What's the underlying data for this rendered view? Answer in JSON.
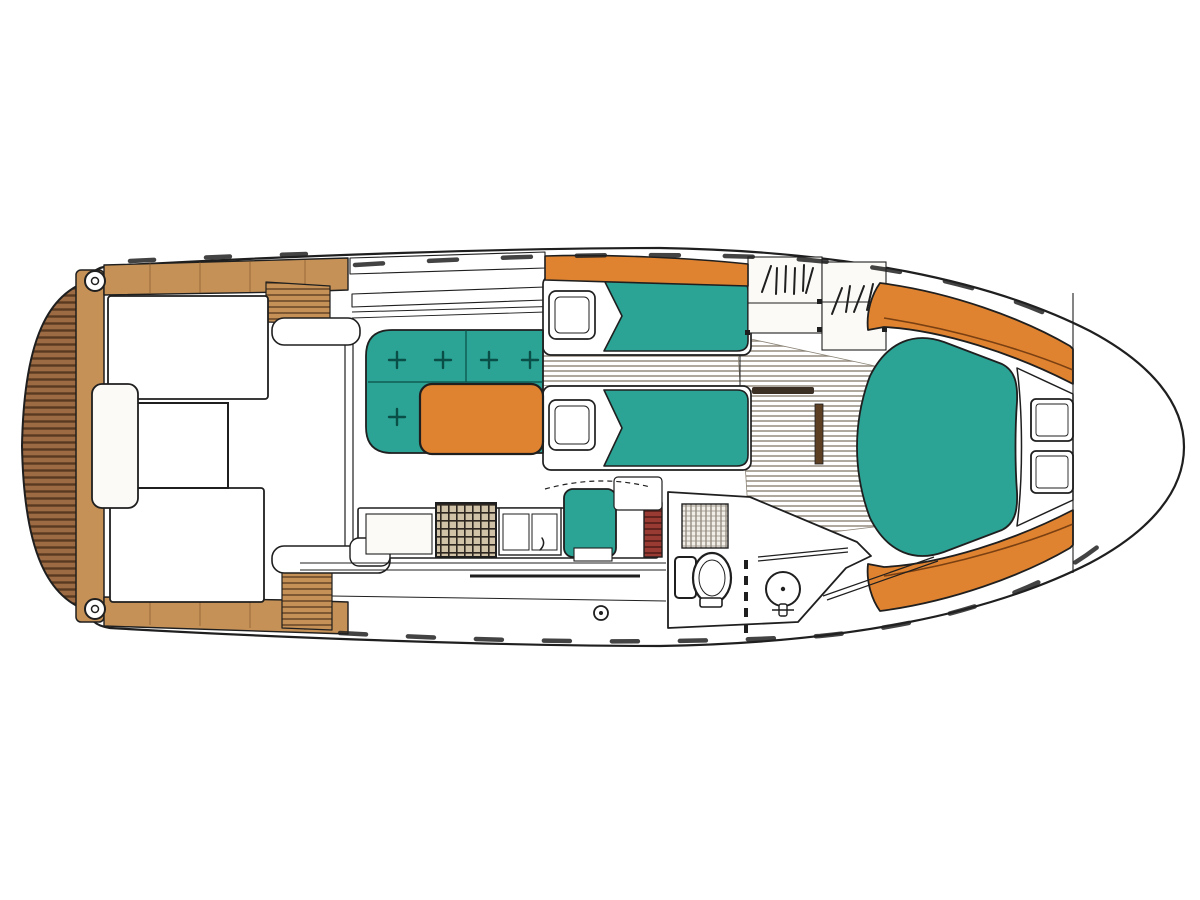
{
  "document": {
    "title": "Motor yacht accommodation / deck floor plan (top view)",
    "type": "boat-floor-plan",
    "orientation": "bow-right",
    "visible_text": []
  },
  "canvas": {
    "width": 1200,
    "height": 900,
    "background": "#ffffff"
  },
  "colors": {
    "line": "#1f1f1f",
    "teal": "#2ba395",
    "tealDark": "#0a4f47",
    "orange": "#e08330",
    "orangeSeam": "#7a4012",
    "teak": "#c59157",
    "teakSeam": "#7c5228",
    "platform": "#9c6b44",
    "platformStripe": "#59391f",
    "floorLine": "#8b8376",
    "maroon": "#993a33",
    "maroonStripe": "#5c1f1b",
    "stoveBase": "#cfc2a6",
    "stoveGrid": "#2e2620",
    "grateBase": "#f1eee8",
    "grateLine": "#948d81"
  },
  "regions": {
    "swim_platform": "Teak swim platform (stern)",
    "transom": "Transom locker band",
    "cockpit": "Aft cockpit with twin benches and table",
    "side_decks": "Port and starboard side decks with steps",
    "windshield": "Wheelhouse windshield",
    "salon": "Salon L-settee with buttoned cushions and table",
    "galley": "Galley: stove, sink, lockers, seat, companionway steps",
    "mid_cabin": "Mid cabin with two single berths and pillows",
    "cabin_sole": "Planked cabin sole / walkway",
    "lockers": "Hanging lockers (hatched symbols)",
    "head": "Head: shower grate, toilet, wash basin, sliding door",
    "v_berth": "Forward V-berth with double pillows",
    "bow_shelves": "Curved bow side shelves",
    "foredeck": "Foredeck inside bow outline",
    "cleats": "Mooring cleats"
  }
}
